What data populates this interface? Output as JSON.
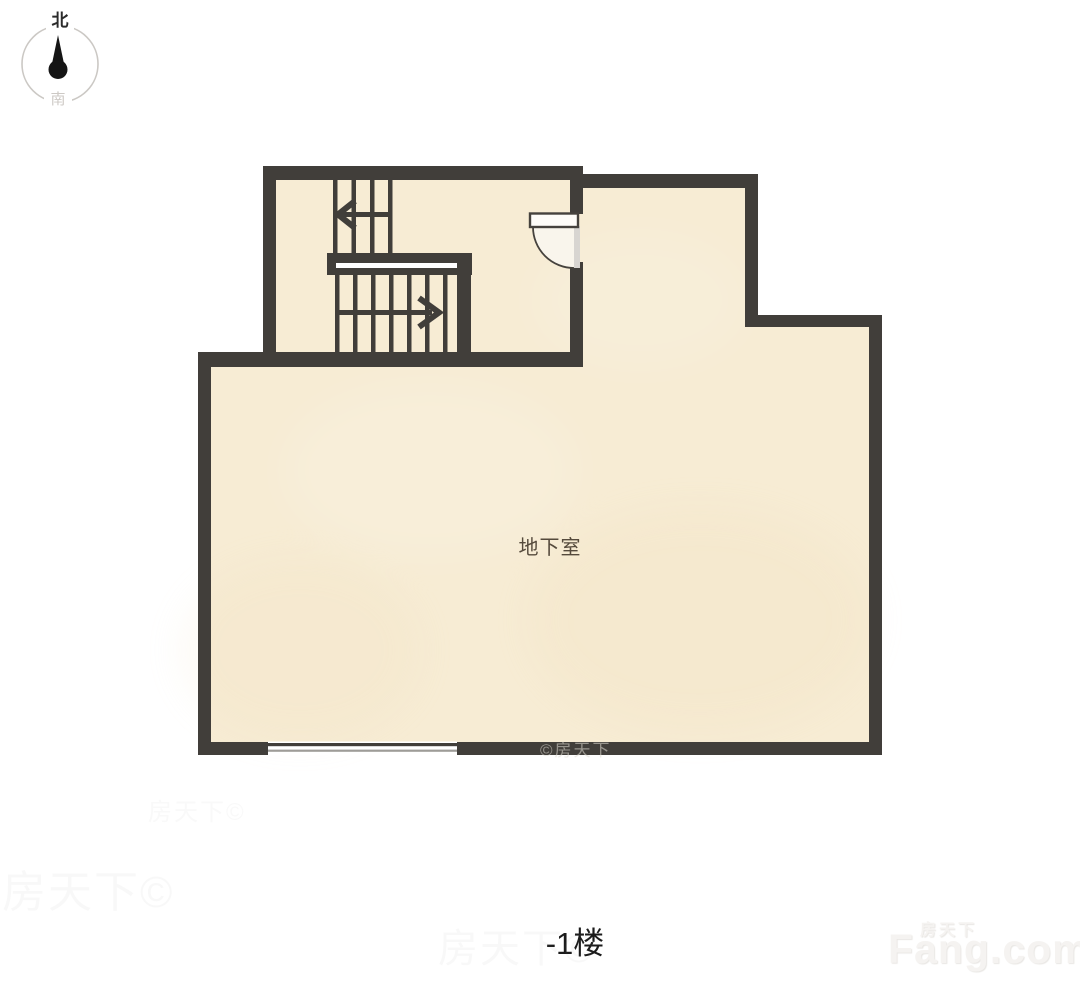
{
  "compass": {
    "north_label": "北",
    "south_label": "南",
    "needle_icon": "north-pointing-needle"
  },
  "plan": {
    "room_label": "地下室",
    "floor_label": "-1楼"
  },
  "stairs": {
    "up_arrow_icon": "arrow-left",
    "down_arrow_icon": "arrow-right"
  },
  "door": {
    "icon": "quarter-arc-door-swing"
  },
  "watermark": {
    "brand_cn": "房天下",
    "brand_en": "Fang.com",
    "wall_stamp": "©房天下",
    "ghost_stamp": "房天下©"
  },
  "colors": {
    "wall": "#413e3a",
    "floor": "#f7ecd4",
    "floor-shade": "#eedcb8",
    "door-frame": "#d8d5d1",
    "room-label": "#554a3c",
    "floor-label": "#1b1b1b",
    "compass-ring": "#cbc8c4",
    "compass-south": "#cdc9c5",
    "needle": "#151515",
    "watermark": "#f5f3f1"
  }
}
